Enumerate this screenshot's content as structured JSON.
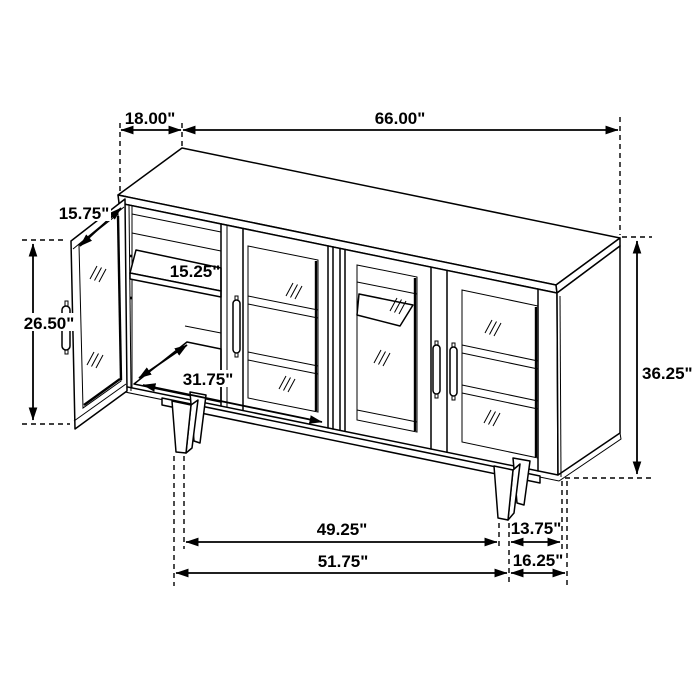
{
  "diagram": {
    "type": "isometric-furniture-dimension-drawing",
    "subject": "sideboard accent cabinet with four glass doors, left door open, tapered legs",
    "units": "inches",
    "line_color": "#000000",
    "background_color": "#ffffff",
    "dimensions": {
      "top_depth": "18.00\"",
      "top_width": "66.00\"",
      "door_width": "15.75\"",
      "door_height": "26.50\"",
      "shelf_depth": "15.25\"",
      "interior_width": "31.75\"",
      "cabinet_height": "36.25\"",
      "legs_inner_span": "49.25\"",
      "leg_side_inset": "13.75\"",
      "legs_outer_span": "51.75\"",
      "base_side_depth": "16.25\""
    }
  }
}
